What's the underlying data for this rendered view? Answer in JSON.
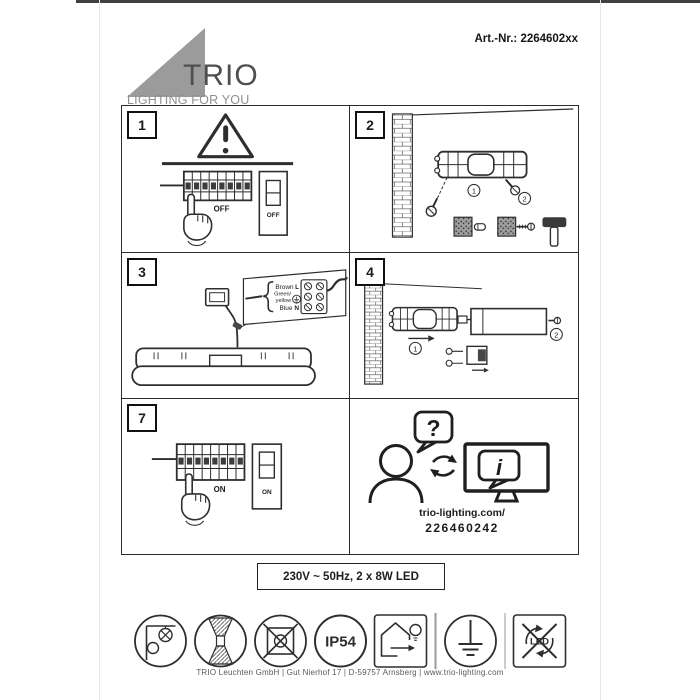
{
  "page": {
    "art_nr": "Art.-Nr.: 2264602xx",
    "brand": {
      "wordmark": "TRIO",
      "tagline": "LIGHTING FOR YOU"
    },
    "spec_label": "230V ~ 50Hz, 2 x 8W LED",
    "footer": "TRIO Leuchten GmbH | Gut Nierhof 17 | D-59757 Arnsberg | www.trio-lighting.com",
    "colors": {
      "logo_gray": "#9b9b9b",
      "ink": "#2e2e2e",
      "scan_strip": "#3f3f3f"
    }
  },
  "steps": {
    "step1": {
      "number": "1",
      "breaker_label": "OFF",
      "switch_label": "OFF",
      "icons": [
        "warning-triangle-icon",
        "circuit-breaker-panel",
        "pointing-hand-icon",
        "wall-switch"
      ]
    },
    "step2": {
      "number": "2",
      "marker1": "1",
      "marker2": "2",
      "icons": [
        "brick-wall",
        "mounting-bracket",
        "screw-icon",
        "wall-plug-icon",
        "hammer-icon"
      ]
    },
    "step3": {
      "number": "3",
      "wires": {
        "live": "Brown",
        "live_terminal": "L",
        "earth_line1": "Green/",
        "earth_line2": "yellow",
        "neutral": "Blue",
        "neutral_terminal": "N"
      },
      "icons": [
        "junction-box",
        "terminal-block",
        "earth-symbol-icon",
        "luminaire-body"
      ]
    },
    "step4": {
      "number": "4",
      "marker1": "1",
      "marker2": "2",
      "icons": [
        "brick-wall",
        "mounting-bracket",
        "driver-box",
        "screw-icon"
      ]
    },
    "step7": {
      "number": "7",
      "breaker_label": "ON",
      "switch_label": "ON",
      "icons": [
        "circuit-breaker-panel",
        "pointing-hand-icon",
        "wall-switch"
      ]
    },
    "support": {
      "question_mark": "?",
      "info_mark": "i",
      "url": "trio-lighting.com/",
      "code": "226460242",
      "icons": [
        "person-silhouette-icon",
        "question-bubble-icon",
        "exchange-arrows-icon",
        "monitor-icon",
        "info-bubble-icon"
      ]
    }
  },
  "symbols": {
    "ip_rating": "IP54",
    "led_label": "LED",
    "list": [
      "wall-mounting-surface-icon",
      "up-down-light-icon",
      "no-cover-icon",
      "ip54-badge",
      "outdoor-use-icon",
      "protective-earth-icon",
      "non-replaceable-led-icon"
    ]
  }
}
